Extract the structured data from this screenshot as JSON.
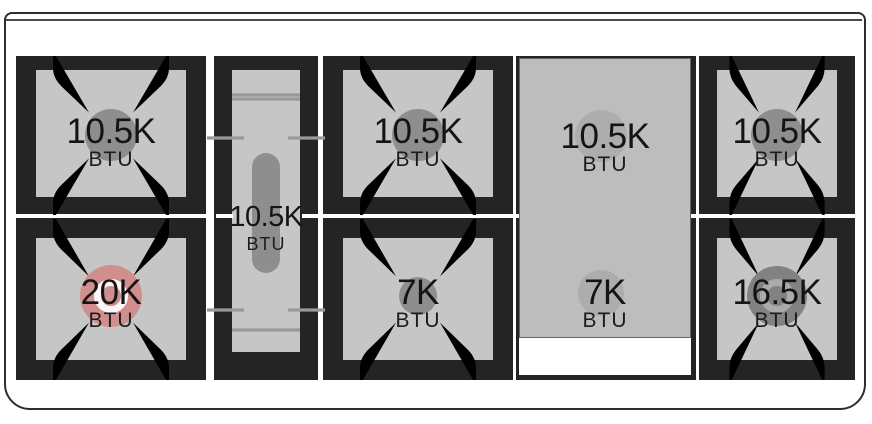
{
  "colors": {
    "highlight": "#d18e8e",
    "grate_black": "#242424",
    "surface_gray": "#c6c6c6",
    "panel_gray": "#bdbdbd",
    "cap_gray": "#8e8e8e",
    "line_gray": "#999999",
    "text": "#111111"
  },
  "cooktop": {
    "burners": {
      "left_rear": {
        "power": "10.5K",
        "unit": "BTU"
      },
      "left_front": {
        "power": "20K",
        "unit": "BTU",
        "highlighted": true
      },
      "center_oval": {
        "power": "10.5K",
        "unit": "BTU"
      },
      "middle_rear": {
        "power": "10.5K",
        "unit": "BTU"
      },
      "middle_front": {
        "power": "7K",
        "unit": "BTU"
      },
      "griddle_rear": {
        "power": "10.5K",
        "unit": "BTU"
      },
      "griddle_front": {
        "power": "7K",
        "unit": "BTU"
      },
      "right_rear": {
        "power": "10.5K",
        "unit": "BTU"
      },
      "right_front": {
        "power": "16.5K",
        "unit": "BTU"
      }
    }
  }
}
